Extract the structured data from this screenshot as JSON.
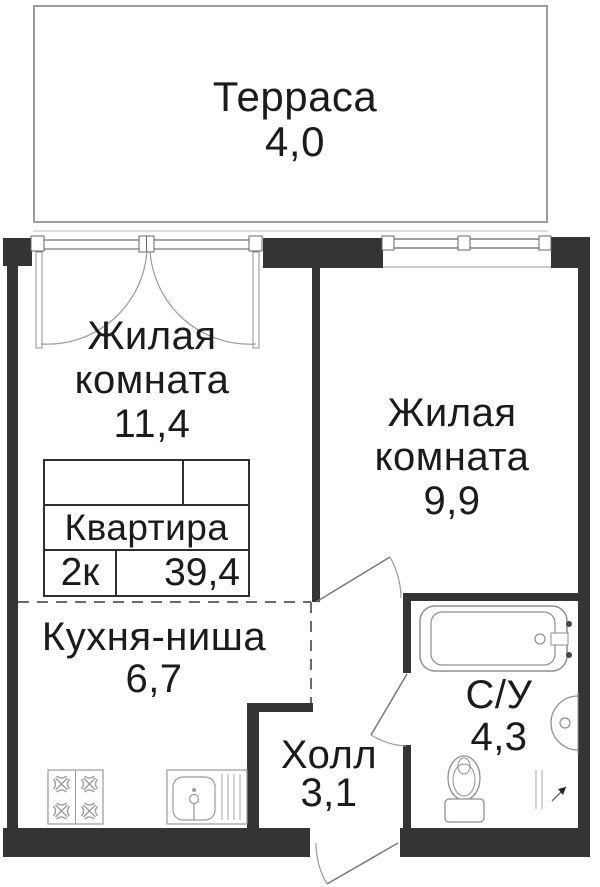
{
  "plan": {
    "title": "Floor plan of 2-room apartment",
    "terrace": {
      "name": "Терраса",
      "area": "4,0"
    },
    "rooms": [
      {
        "key": "living-room-1",
        "name": "Жилая",
        "name2": "комната",
        "area": "11,4"
      },
      {
        "key": "living-room-2",
        "name": "Жилая",
        "name2": "комната",
        "area": "9,9"
      },
      {
        "key": "kitchen-niche",
        "name": "Кухня-ниша",
        "area": "6,7"
      },
      {
        "key": "hall",
        "name": "Холл",
        "area": "3,1"
      },
      {
        "key": "bathroom",
        "name": "С/У",
        "area": "4,3"
      }
    ],
    "summary": {
      "title": "Квартира",
      "rooms_label": "2к",
      "total_area": "39,4"
    },
    "fixtures": [
      "bathtub-icon",
      "washbasin-icon",
      "toilet-icon",
      "stove-icon",
      "kitchen-sink-icon"
    ],
    "colors": {
      "wall": "#343434",
      "fixture_line": "#8f8f8f",
      "text": "#1b1b1b",
      "terrace_line": "#9c9c9c"
    }
  }
}
